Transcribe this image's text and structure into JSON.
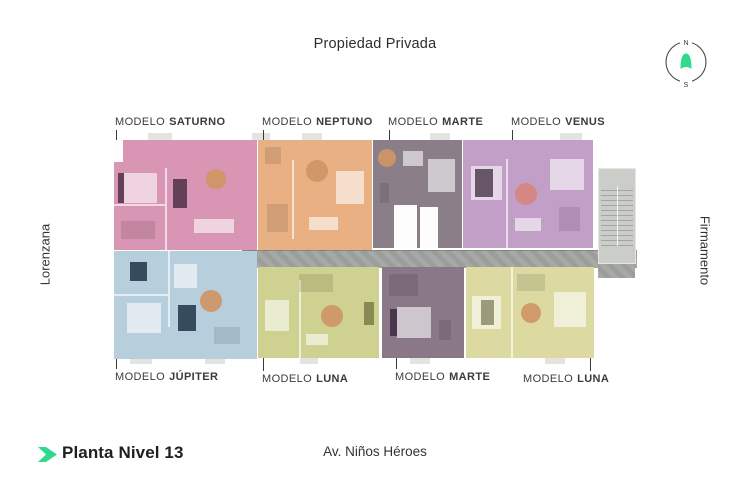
{
  "header": {
    "top_label": "Propiedad Privada"
  },
  "streets": {
    "left": "Lorenzana",
    "right": "Firmamento",
    "bottom": "Av. Niños Héroes"
  },
  "footer": {
    "plan_title": "Planta Nivel 13"
  },
  "compass": {
    "north": "N",
    "south": "S"
  },
  "units": [
    {
      "id": "saturno",
      "prefix": "MODELO",
      "name": "SATURNO",
      "color": "#d996b4"
    },
    {
      "id": "neptuno",
      "prefix": "MODELO",
      "name": "NEPTUNO",
      "color": "#e8b083"
    },
    {
      "id": "marte-top",
      "prefix": "MODELO",
      "name": "MARTE",
      "color": "#8a7e88"
    },
    {
      "id": "venus",
      "prefix": "MODELO",
      "name": "VENUS",
      "color": "#c29fc7"
    },
    {
      "id": "jupiter",
      "prefix": "MODELO",
      "name": "JÚPITER",
      "color": "#b7cedd"
    },
    {
      "id": "luna-left",
      "prefix": "MODELO",
      "name": "LUNA",
      "color": "#ced190"
    },
    {
      "id": "marte-bottom",
      "prefix": "MODELO",
      "name": "MARTE",
      "color": "#8a7888"
    },
    {
      "id": "luna-right",
      "prefix": "MODELO",
      "name": "LUNA",
      "color": "#dcdaa0"
    }
  ],
  "colors": {
    "accent_green": "#31d98c",
    "corridor_gray": "#a2a4a2",
    "stairs_gray": "#cbcdc9",
    "label_text": "#3b3b3b"
  }
}
